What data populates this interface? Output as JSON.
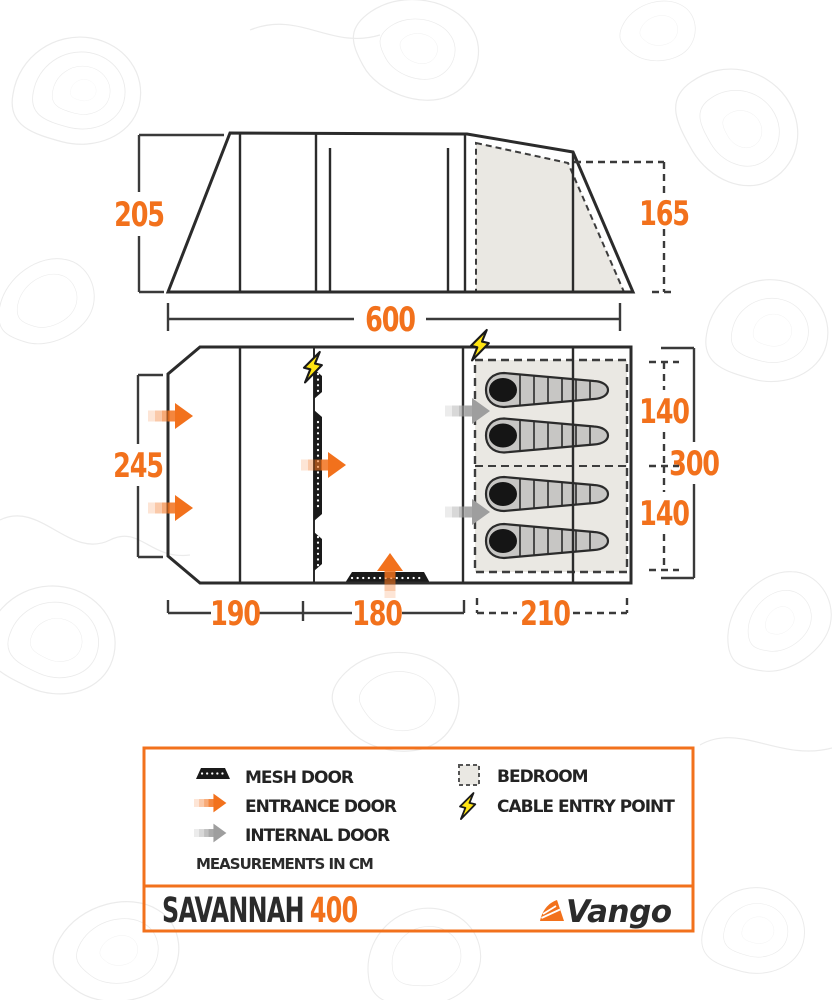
{
  "product": {
    "series": "SAVANNAH",
    "model": "400"
  },
  "brand": {
    "wordmark": "Vango"
  },
  "side_elevation": {
    "front_height_cm": "205",
    "rear_height_cm": "165"
  },
  "floor_plan": {
    "total_length_cm": "600",
    "front_width_cm": "245",
    "rear_width_cm": "300",
    "porch_section_cm": "190",
    "living_section_cm": "180",
    "bedroom_section_cm": "210",
    "bedroom_upper_cm": "140",
    "bedroom_lower_cm": "140",
    "sleeping_bag_count": 4
  },
  "legend": {
    "items": [
      {
        "icon": "mesh-door-icon",
        "label": "MESH DOOR"
      },
      {
        "icon": "entrance-door-icon",
        "label": "ENTRANCE DOOR"
      },
      {
        "icon": "internal-door-icon",
        "label": "INTERNAL DOOR"
      },
      {
        "icon": "bedroom-icon",
        "label": "BEDROOM"
      },
      {
        "icon": "cable-entry-point-icon",
        "label": "CABLE ENTRY POINT"
      }
    ],
    "note": "MEASUREMENTS IN CM"
  },
  "colors": {
    "accent_orange": "#F2711C",
    "line_dark": "#2B2B2B",
    "bedroom_fill": "#EAE8E3",
    "bolt_yellow": "#FFE412",
    "internal_arrow_gray": "#9E9E9E"
  }
}
